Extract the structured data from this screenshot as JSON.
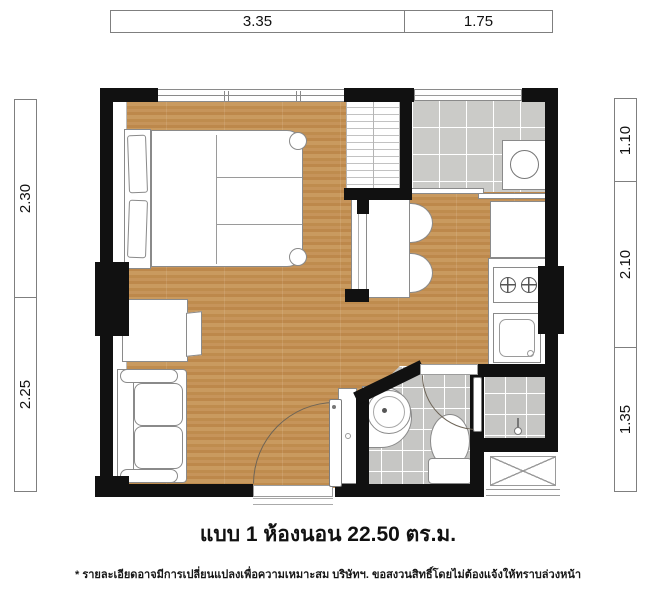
{
  "caption": {
    "title": "แบบ 1 ห้องนอน 22.50 ตร.ม.",
    "disclaimer": "* รายละเอียดอาจมีการเปลี่ยนแปลงเพื่อความเหมาะสม บริษัทฯ. ขอสงวนสิทธิ์โดยไม่ต้องแจ้งให้ทราบล่วงหน้า"
  },
  "dimensions": {
    "top": [
      "3.35",
      "1.75"
    ],
    "left": [
      "2.30",
      "2.25"
    ],
    "right": [
      "1.10",
      "2.10",
      "1.35"
    ]
  },
  "colors": {
    "wall": "#111111",
    "wood": "#c2904f",
    "tile": "#cbcbc8",
    "outline": "#8a8a8a",
    "arc": "#6d6457",
    "dim-border": "#7f7f7f",
    "text": "#1c1c1c"
  },
  "icons": {
    "bed": "double-bed",
    "sofa": "two-seat-sofa",
    "tv": "television",
    "wardrobe": "wardrobe-shelves",
    "washing_machine": "washing-machine",
    "dining_table": "dining-table",
    "chair": "half-round-chair",
    "fridge": "refrigerator",
    "stove": "two-burner-stove",
    "sink": "kitchen-sink",
    "basin": "round-basin",
    "toilet": "toilet",
    "shower": "shower-valve"
  }
}
